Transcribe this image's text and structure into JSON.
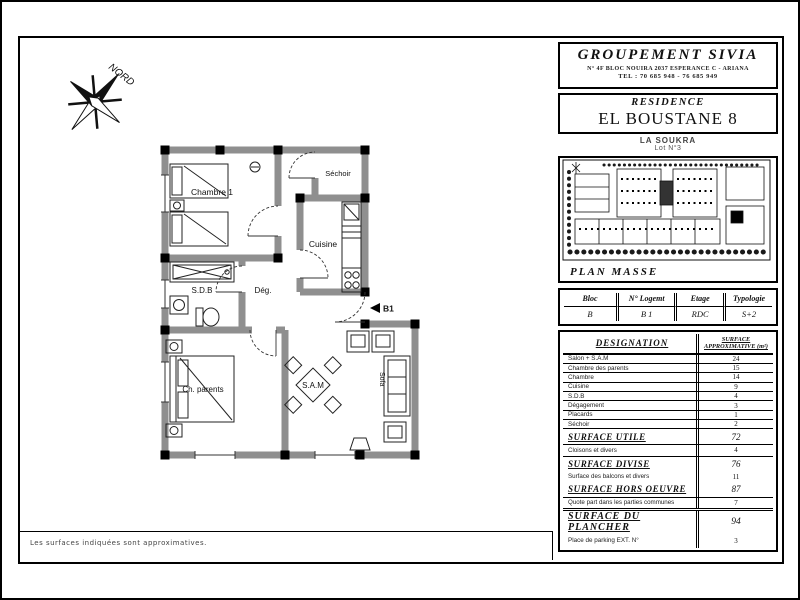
{
  "north_label": "NORD",
  "floor_plan": {
    "rooms": {
      "chambre1": "Chambre 1",
      "sechoir": "Séchoir",
      "cuisine": "Cuisine",
      "degagement": "Dég.",
      "sdb": "S.D.B",
      "ch_parents": "Ch. parents",
      "sam": "S.A.M",
      "sofa": "Sofa"
    },
    "entrance": "B1"
  },
  "company": {
    "name": "GROUPEMENT SIVIA",
    "address": "N° 4F BLOC NOUIRA 2037 ESPERANCE C - ARIANA",
    "phone": "TEL : 70 685 948 - 76 685 949"
  },
  "residence": {
    "kicker": "RESIDENCE",
    "name": "EL BOUSTANE 8",
    "location": "LA SOUKRA",
    "lot": "Lot N°3"
  },
  "plan_masse": {
    "label": "PLAN MASSE"
  },
  "unit_table": {
    "headers": {
      "bloc": "Bloc",
      "logement": "N° Logemt",
      "etage": "Etage",
      "typologie": "Typologie"
    },
    "values": {
      "bloc": "B",
      "logement": "B 1",
      "etage": "RDC",
      "typologie": "S+2"
    }
  },
  "surface_table": {
    "col_designation": "DESIGNATION",
    "col_surface": "SURFACE APPROXIMATIVE (m²)",
    "rows": [
      {
        "label": "Salon + S.A.M",
        "value": "24"
      },
      {
        "label": "Chambre des parents",
        "value": "15"
      },
      {
        "label": "Chambre",
        "value": "14"
      },
      {
        "label": "Cuisine",
        "value": "9"
      },
      {
        "label": "S.D.B",
        "value": "4"
      },
      {
        "label": "Dégagement",
        "value": "3"
      },
      {
        "label": "Placards",
        "value": "1"
      },
      {
        "label": "Séchoir",
        "value": "2"
      }
    ],
    "summary": [
      {
        "label": "SURFACE UTILE",
        "value": "72"
      },
      {
        "label": "Cloisons et divers",
        "value": "4"
      },
      {
        "label": "SURFACE DIVISE",
        "value": "76"
      },
      {
        "label": "Surface des balcons et divers",
        "value": "11"
      },
      {
        "label": "SURFACE HORS OEUVRE",
        "value": "87"
      },
      {
        "label": "Quote part dans les parties communes",
        "value": "7"
      }
    ],
    "floor_rows": [
      {
        "label": "SURFACE DU PLANCHER",
        "value": "94"
      },
      {
        "label": "Place de parking EXT. N°",
        "value": "3"
      }
    ]
  },
  "page": {
    "footnote": "Les surfaces indiquées sont approximatives."
  }
}
